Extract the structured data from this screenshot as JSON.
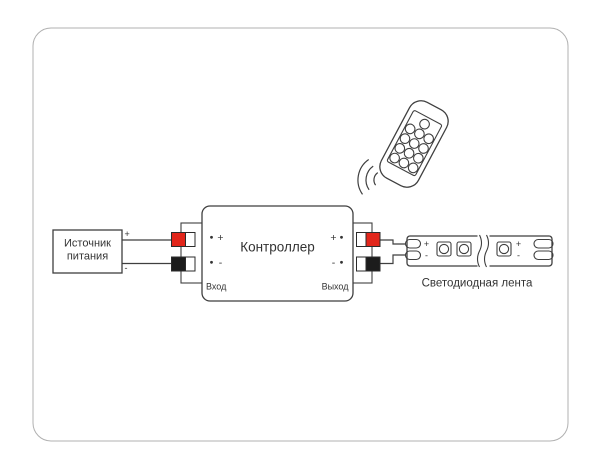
{
  "diagram": {
    "power_source": {
      "label_line1": "Источник",
      "label_line2": "питания",
      "plus": "+",
      "minus": "-"
    },
    "controller": {
      "name": "Контроллер",
      "input_label": "Вход",
      "output_label": "Выход",
      "input_plus": "+",
      "input_minus": "-",
      "output_plus": "+",
      "output_minus": "-"
    },
    "led_strip": {
      "name": "Светодиодная лента",
      "left_plus": "+",
      "left_minus": "-",
      "right_plus": "+",
      "right_minus": "-"
    },
    "colors": {
      "positive_terminal": "#e2261b",
      "negative_terminal": "#1c1c1c",
      "line": "#3f3f3f",
      "text": "#333333",
      "frame": "#b0b0b0"
    }
  }
}
